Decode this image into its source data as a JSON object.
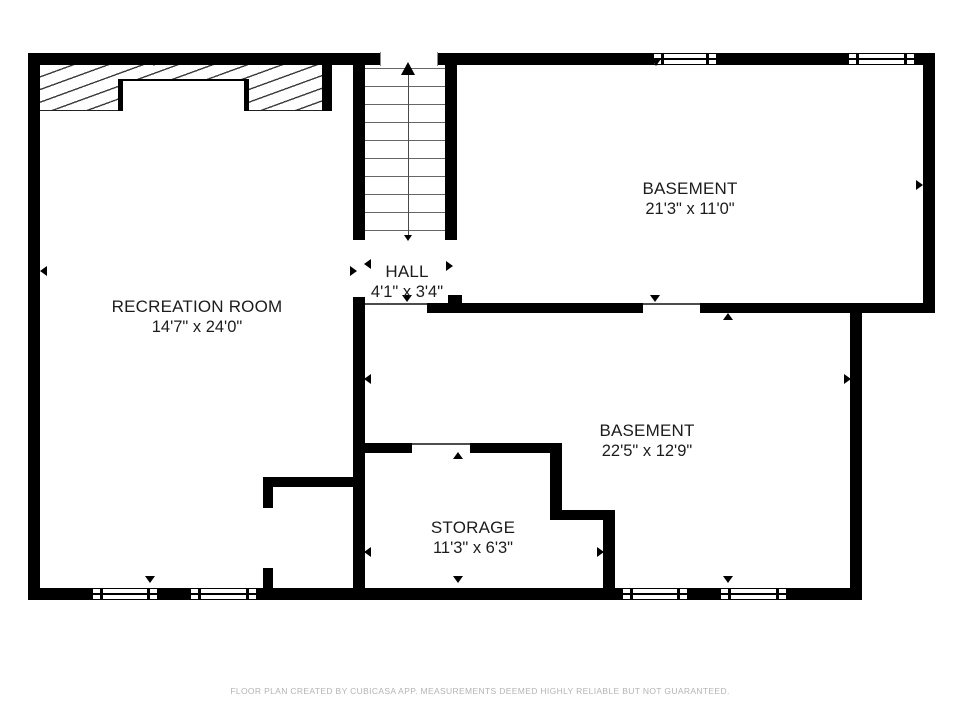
{
  "footer_note": "FLOOR PLAN CREATED BY CUBICASA APP. MEASUREMENTS DEEMED HIGHLY RELIABLE BUT NOT GUARANTEED.",
  "colors": {
    "wall": "#000000",
    "thin_line": "#4d4d4d",
    "tread_line": "#666666",
    "text": "#1c1c1c",
    "footer_text": "#b4b4b4",
    "background": "#ffffff"
  },
  "rooms": [
    {
      "id": "recreation-room",
      "name": "RECREATION ROOM",
      "dims": "14'7\" x 24'0\"",
      "cx": 197,
      "cy": 317
    },
    {
      "id": "hall",
      "name": "HALL",
      "dims": "4'1\" x 3'4\"",
      "cx": 407,
      "cy": 282
    },
    {
      "id": "basement-upper",
      "name": "BASEMENT",
      "dims": "21'3\" x 11'0\"",
      "cx": 690,
      "cy": 199
    },
    {
      "id": "basement-lower",
      "name": "BASEMENT",
      "dims": "22'5\" x 12'9\"",
      "cx": 647,
      "cy": 441
    },
    {
      "id": "storage",
      "name": "STORAGE",
      "dims": "11'3\" x 6'3\"",
      "cx": 473,
      "cy": 538
    }
  ],
  "plan": {
    "walls": [
      {
        "x": 28,
        "y": 53,
        "w": 907,
        "h": 12
      },
      {
        "x": 28,
        "y": 53,
        "w": 12,
        "h": 547
      },
      {
        "x": 28,
        "y": 588,
        "w": 834,
        "h": 12
      },
      {
        "x": 923,
        "y": 53,
        "w": 12,
        "h": 260
      },
      {
        "x": 427,
        "y": 303,
        "w": 508,
        "h": 10
      },
      {
        "x": 850,
        "y": 303,
        "w": 12,
        "h": 297
      },
      {
        "x": 353,
        "y": 60,
        "w": 12,
        "h": 180
      },
      {
        "x": 445,
        "y": 60,
        "w": 12,
        "h": 180
      },
      {
        "x": 353,
        "y": 297,
        "w": 12,
        "h": 303
      },
      {
        "x": 448,
        "y": 295,
        "w": 14,
        "h": 10
      },
      {
        "x": 353,
        "y": 443,
        "w": 209,
        "h": 10
      },
      {
        "x": 550,
        "y": 443,
        "w": 12,
        "h": 77
      },
      {
        "x": 550,
        "y": 510,
        "w": 65,
        "h": 10
      },
      {
        "x": 603,
        "y": 510,
        "w": 12,
        "h": 90
      },
      {
        "x": 263,
        "y": 477,
        "w": 100,
        "h": 10
      },
      {
        "x": 263,
        "y": 477,
        "w": 10,
        "h": 123
      }
    ],
    "gaps": [
      {
        "x": 380,
        "y": 52,
        "w": 58,
        "h": 14,
        "sides": true
      },
      {
        "x": 643,
        "y": 303,
        "w": 57,
        "h": 10
      },
      {
        "x": 412,
        "y": 443,
        "w": 58,
        "h": 10
      },
      {
        "x": 263,
        "y": 508,
        "w": 10,
        "h": 60
      }
    ],
    "passage_lines": [
      {
        "x": 365,
        "y": 303,
        "w": 62,
        "h": 2
      },
      {
        "x": 643,
        "y": 303,
        "w": 57,
        "h": 2
      },
      {
        "x": 412,
        "y": 443,
        "w": 58,
        "h": 2
      }
    ],
    "windows": [
      {
        "x": 653,
        "y": 53,
        "w": 64,
        "h": 12
      },
      {
        "x": 848,
        "y": 53,
        "w": 67,
        "h": 12
      },
      {
        "x": 92,
        "y": 588,
        "w": 66,
        "h": 12
      },
      {
        "x": 190,
        "y": 588,
        "w": 67,
        "h": 12
      },
      {
        "x": 622,
        "y": 588,
        "w": 66,
        "h": 12
      },
      {
        "x": 720,
        "y": 588,
        "w": 67,
        "h": 12
      }
    ],
    "hatch": {
      "area": {
        "x": 40,
        "y": 65,
        "w": 292,
        "h": 46
      },
      "end_bar": {
        "x": 322,
        "y": 65,
        "w": 10,
        "h": 46
      },
      "white_box": {
        "x": 118,
        "y": 79,
        "w": 131,
        "h": 32
      }
    },
    "stairs": {
      "x1": 365,
      "x2": 445,
      "tread_ys": [
        68,
        86,
        104,
        122,
        140,
        158,
        176,
        194,
        212,
        230
      ],
      "center_x": 408,
      "line_y1": 74,
      "line_y2": 236
    },
    "arrows": [
      {
        "x": 408,
        "y": 62,
        "d": "up",
        "hb": 7,
        "dp": 13
      },
      {
        "x": 408,
        "y": 241,
        "d": "down",
        "hb": 4,
        "dp": 6
      },
      {
        "x": 154,
        "y": 66,
        "d": "down"
      },
      {
        "x": 656,
        "y": 66,
        "d": "down"
      },
      {
        "x": 40,
        "y": 271,
        "d": "left"
      },
      {
        "x": 357,
        "y": 271,
        "d": "right"
      },
      {
        "x": 364,
        "y": 264,
        "d": "left"
      },
      {
        "x": 453,
        "y": 266,
        "d": "right"
      },
      {
        "x": 407,
        "y": 302,
        "d": "down"
      },
      {
        "x": 655,
        "y": 302,
        "d": "down"
      },
      {
        "x": 728,
        "y": 313,
        "d": "up"
      },
      {
        "x": 923,
        "y": 185,
        "d": "right"
      },
      {
        "x": 851,
        "y": 379,
        "d": "right"
      },
      {
        "x": 364,
        "y": 379,
        "d": "left"
      },
      {
        "x": 458,
        "y": 452,
        "d": "up"
      },
      {
        "x": 364,
        "y": 552,
        "d": "left"
      },
      {
        "x": 604,
        "y": 552,
        "d": "right"
      },
      {
        "x": 458,
        "y": 583,
        "d": "down"
      },
      {
        "x": 150,
        "y": 583,
        "d": "down"
      },
      {
        "x": 728,
        "y": 583,
        "d": "down"
      }
    ]
  }
}
